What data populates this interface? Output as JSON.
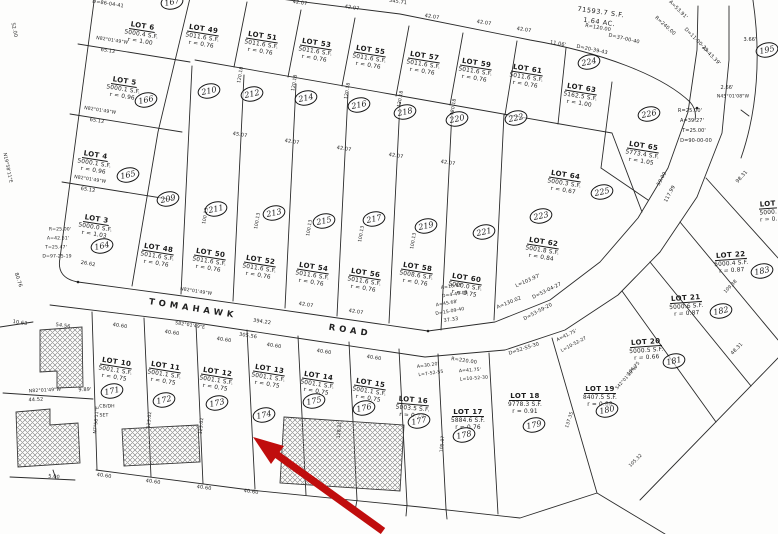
{
  "road": {
    "word1": "TOMAHAWK",
    "word2": "ROAD"
  },
  "open_parcel": {
    "area": "71593.7 S.F.",
    "acres": "1.64 AC."
  },
  "arrow": {
    "color": "#c00d0d"
  },
  "lots": [
    {
      "name": "LOT 6",
      "area": "5000.4 S.F.",
      "ratio": "r = 1.00",
      "x": 142,
      "y": 14,
      "rot": 9
    },
    {
      "name": "LOT 5",
      "area": "5000.1 S.F.",
      "ratio": "r = 0.96",
      "x": 124,
      "y": 69,
      "rot": 9
    },
    {
      "name": "LOT 4",
      "area": "5000.1 S.F.",
      "ratio": "r = 0.96",
      "x": 95,
      "y": 143,
      "rot": 9
    },
    {
      "name": "LOT 3",
      "area": "5000.0 S.F.",
      "ratio": "r = 1.03",
      "x": 96,
      "y": 207,
      "rot": 9
    },
    {
      "name": "LOT 49",
      "area": "5011.6 S.F.",
      "ratio": "r = 0.76",
      "x": 203,
      "y": 17,
      "rot": 9
    },
    {
      "name": "LOT 51",
      "area": "5011.6 S.F.",
      "ratio": "r = 0.76",
      "x": 262,
      "y": 24,
      "rot": 9
    },
    {
      "name": "LOT 53",
      "area": "5011.6 S.F.",
      "ratio": "r = 0.76",
      "x": 316,
      "y": 31,
      "rot": 9
    },
    {
      "name": "LOT 55",
      "area": "5011.6 S.F.",
      "ratio": "r = 0.76",
      "x": 370,
      "y": 38,
      "rot": 9
    },
    {
      "name": "LOT 57",
      "area": "5011.6 S.F.",
      "ratio": "r = 0.76",
      "x": 424,
      "y": 44,
      "rot": 9
    },
    {
      "name": "LOT 59",
      "area": "5011.6 S.F.",
      "ratio": "r = 0.76",
      "x": 476,
      "y": 51,
      "rot": 9
    },
    {
      "name": "LOT 61",
      "area": "5011.6 S.F.",
      "ratio": "r = 0.76",
      "x": 527,
      "y": 57,
      "rot": 9
    },
    {
      "name": "LOT 63",
      "area": "5162.5 S.F.",
      "ratio": "r = 1.00",
      "x": 581,
      "y": 76,
      "rot": 9
    },
    {
      "name": "LOT 65",
      "area": "5773.4 S.F.",
      "ratio": "r = 1.05",
      "x": 643,
      "y": 134,
      "rot": 9
    },
    {
      "name": "LOT 64",
      "area": "5000.3 S.F.",
      "ratio": "r = 0.67",
      "x": 565,
      "y": 163,
      "rot": 9
    },
    {
      "name": "LOT 48",
      "area": "5011.6 S.F.",
      "ratio": "r = 0.76",
      "x": 158,
      "y": 236,
      "rot": 9
    },
    {
      "name": "LOT 50",
      "area": "5011.6 S.F.",
      "ratio": "r = 0.76",
      "x": 210,
      "y": 241,
      "rot": 9
    },
    {
      "name": "LOT 52",
      "area": "5011.6 S.F.",
      "ratio": "r = 0.76",
      "x": 260,
      "y": 248,
      "rot": 9
    },
    {
      "name": "LOT 54",
      "area": "5011.6 S.F.",
      "ratio": "r = 0.76",
      "x": 313,
      "y": 255,
      "rot": 9
    },
    {
      "name": "LOT 56",
      "area": "5011.6 S.F.",
      "ratio": "r = 0.76",
      "x": 365,
      "y": 261,
      "rot": 9
    },
    {
      "name": "LOT 58",
      "area": "5008.6 S.F.",
      "ratio": "r = 0.76",
      "x": 417,
      "y": 255,
      "rot": 9
    },
    {
      "name": "LOT 60",
      "area": "5000.0 S.F.",
      "ratio": "r = 0.75",
      "x": 466,
      "y": 266,
      "rot": 9
    },
    {
      "name": "LOT 62",
      "area": "5001.8 S.F.",
      "ratio": "r = 0.84",
      "x": 543,
      "y": 230,
      "rot": 9
    },
    {
      "name": "LOT 10",
      "area": "5001.1 S.F.",
      "ratio": "r = 0.75",
      "x": 116,
      "y": 350,
      "rot": 9
    },
    {
      "name": "LOT 11",
      "area": "5001.1 S.F.",
      "ratio": "r = 0.75",
      "x": 165,
      "y": 354,
      "rot": 9
    },
    {
      "name": "LOT 12",
      "area": "5001.1 S.F.",
      "ratio": "r = 0.75",
      "x": 217,
      "y": 360,
      "rot": 9
    },
    {
      "name": "LOT 13",
      "area": "5001.1 S.F.",
      "ratio": "r = 0.75",
      "x": 269,
      "y": 357,
      "rot": 9
    },
    {
      "name": "LOT 14",
      "area": "5001.1 S.F.",
      "ratio": "r = 0.75",
      "x": 318,
      "y": 364,
      "rot": 9
    },
    {
      "name": "LOT 15",
      "area": "5001.1 S.F.",
      "ratio": "r = 0.75",
      "x": 370,
      "y": 371,
      "rot": 9
    },
    {
      "name": "LOT 16",
      "area": "5003.5 S.F.",
      "ratio": "r = 0.74",
      "x": 413,
      "y": 388,
      "rot": 5
    },
    {
      "name": "LOT 17",
      "area": "5884.6 S.F.",
      "ratio": "r = 0.76",
      "x": 468,
      "y": 400,
      "rot": 0
    },
    {
      "name": "LOT 18",
      "area": "9778.3 S.F.",
      "ratio": "r = 0.91",
      "x": 525,
      "y": 384,
      "rot": 0
    },
    {
      "name": "LOT 19",
      "area": "8407.5 S.F.",
      "ratio": "r = 0.88",
      "x": 600,
      "y": 377,
      "rot": 0
    },
    {
      "name": "LOT 20",
      "area": "5000.5 S.F.",
      "ratio": "r = 0.66",
      "x": 646,
      "y": 330,
      "rot": -4
    },
    {
      "name": "LOT 21",
      "area": "5000.6 S.F.",
      "ratio": "r = 0.87",
      "x": 686,
      "y": 286,
      "rot": -4
    },
    {
      "name": "LOT 22",
      "area": "5000.4 S.F.",
      "ratio": "r = 0.87",
      "x": 731,
      "y": 243,
      "rot": -4
    },
    {
      "name": "LOT",
      "area": "5000.",
      "ratio": "r = 0.",
      "x": 768,
      "y": 192,
      "rot": -4
    }
  ],
  "badges": [
    {
      "num": "167",
      "x": 172,
      "y": 2
    },
    {
      "num": "166",
      "x": 146,
      "y": 100
    },
    {
      "num": "165",
      "x": 128,
      "y": 175
    },
    {
      "num": "164",
      "x": 102,
      "y": 246
    },
    {
      "num": "210",
      "x": 209,
      "y": 91
    },
    {
      "num": "212",
      "x": 252,
      "y": 94
    },
    {
      "num": "214",
      "x": 306,
      "y": 98
    },
    {
      "num": "216",
      "x": 359,
      "y": 105
    },
    {
      "num": "218",
      "x": 405,
      "y": 112
    },
    {
      "num": "220",
      "x": 457,
      "y": 119
    },
    {
      "num": "222",
      "x": 516,
      "y": 118
    },
    {
      "num": "224",
      "x": 589,
      "y": 62
    },
    {
      "num": "226",
      "x": 649,
      "y": 114
    },
    {
      "num": "209",
      "x": 168,
      "y": 199
    },
    {
      "num": "211",
      "x": 216,
      "y": 209
    },
    {
      "num": "213",
      "x": 274,
      "y": 213
    },
    {
      "num": "215",
      "x": 324,
      "y": 221
    },
    {
      "num": "217",
      "x": 374,
      "y": 219
    },
    {
      "num": "219",
      "x": 426,
      "y": 226
    },
    {
      "num": "221",
      "x": 484,
      "y": 232
    },
    {
      "num": "223",
      "x": 541,
      "y": 216
    },
    {
      "num": "225",
      "x": 602,
      "y": 192
    },
    {
      "num": "171",
      "x": 112,
      "y": 391
    },
    {
      "num": "172",
      "x": 164,
      "y": 400
    },
    {
      "num": "173",
      "x": 217,
      "y": 403
    },
    {
      "num": "174",
      "x": 264,
      "y": 415
    },
    {
      "num": "175",
      "x": 314,
      "y": 401
    },
    {
      "num": "176",
      "x": 364,
      "y": 408
    },
    {
      "num": "177",
      "x": 419,
      "y": 421
    },
    {
      "num": "178",
      "x": 464,
      "y": 435
    },
    {
      "num": "179",
      "x": 534,
      "y": 425
    },
    {
      "num": "180",
      "x": 607,
      "y": 410
    },
    {
      "num": "181",
      "x": 674,
      "y": 361
    },
    {
      "num": "182",
      "x": 721,
      "y": 311
    },
    {
      "num": "183",
      "x": 762,
      "y": 271
    },
    {
      "num": "195",
      "x": 767,
      "y": 50
    }
  ],
  "annotations": [
    {
      "text": "D=86-04-41",
      "x": 108,
      "y": 4,
      "rot": 9
    },
    {
      "text": "42.07",
      "x": 300,
      "y": 3,
      "rot": 9
    },
    {
      "text": "42.07",
      "x": 352,
      "y": 8,
      "rot": 9
    },
    {
      "text": "345.71",
      "x": 398,
      "y": 2,
      "rot": 9
    },
    {
      "text": "42.07",
      "x": 432,
      "y": 17,
      "rot": 9
    },
    {
      "text": "42.07",
      "x": 484,
      "y": 23,
      "rot": 9
    },
    {
      "text": "42.07",
      "x": 524,
      "y": 30,
      "rot": 9
    },
    {
      "text": "N82°01'49\"W",
      "x": 112,
      "y": 41,
      "rot": 9,
      "size": 4.6
    },
    {
      "text": "65.12",
      "x": 108,
      "y": 51,
      "rot": 9
    },
    {
      "text": "N82°01'49\"W",
      "x": 100,
      "y": 111,
      "rot": 9,
      "size": 4.6
    },
    {
      "text": "65.12",
      "x": 97,
      "y": 121,
      "rot": 9
    },
    {
      "text": "N82°01'49\"W",
      "x": 90,
      "y": 180,
      "rot": 9,
      "size": 4.6
    },
    {
      "text": "65.12",
      "x": 88,
      "y": 190,
      "rot": 9
    },
    {
      "text": "52.00",
      "x": 14,
      "y": 30,
      "rot": 78
    },
    {
      "text": "N19°58'11\"E",
      "x": 7,
      "y": 168,
      "rot": 78,
      "size": 4.6
    },
    {
      "text": "80.76",
      "x": 18,
      "y": 280,
      "rot": 72
    },
    {
      "text": "26.62",
      "x": 88,
      "y": 264,
      "rot": 10
    },
    {
      "text": "120.18",
      "x": 241,
      "y": 75,
      "rot": -80,
      "size": 4.6
    },
    {
      "text": "120.18",
      "x": 295,
      "y": 83,
      "rot": -80,
      "size": 4.6
    },
    {
      "text": "120.18",
      "x": 348,
      "y": 91,
      "rot": -80,
      "size": 4.6
    },
    {
      "text": "120.18",
      "x": 401,
      "y": 99,
      "rot": -80,
      "size": 4.6
    },
    {
      "text": "120.18",
      "x": 454,
      "y": 107,
      "rot": -80,
      "size": 4.6
    },
    {
      "text": "45.07",
      "x": 240,
      "y": 135,
      "rot": 9
    },
    {
      "text": "42.07",
      "x": 292,
      "y": 142,
      "rot": 9
    },
    {
      "text": "42.07",
      "x": 344,
      "y": 149,
      "rot": 9
    },
    {
      "text": "42.07",
      "x": 396,
      "y": 156,
      "rot": 9
    },
    {
      "text": "42.07",
      "x": 448,
      "y": 163,
      "rot": 9
    },
    {
      "text": "100.13",
      "x": 206,
      "y": 216,
      "rot": -80,
      "size": 4.6
    },
    {
      "text": "100.13",
      "x": 258,
      "y": 221,
      "rot": -80,
      "size": 4.6
    },
    {
      "text": "100.13",
      "x": 310,
      "y": 228,
      "rot": -80,
      "size": 4.6
    },
    {
      "text": "100.13",
      "x": 362,
      "y": 234,
      "rot": -80,
      "size": 4.6
    },
    {
      "text": "100.13",
      "x": 414,
      "y": 241,
      "rot": -80,
      "size": 4.6
    },
    {
      "text": "R=120.00",
      "x": 598,
      "y": 28,
      "rot": 10
    },
    {
      "text": "D=37-00-40",
      "x": 624,
      "y": 39,
      "rot": 13
    },
    {
      "text": "11.06'",
      "x": 558,
      "y": 44,
      "rot": 10
    },
    {
      "text": "D=20-39-43",
      "x": 592,
      "y": 50,
      "rot": 12
    },
    {
      "text": "A=53.91'",
      "x": 678,
      "y": 10,
      "rot": 45
    },
    {
      "text": "R=240.00",
      "x": 665,
      "y": 26,
      "rot": 42
    },
    {
      "text": "D=11-00-29",
      "x": 696,
      "y": 40,
      "rot": 45
    },
    {
      "text": "A=43.39'",
      "x": 711,
      "y": 56,
      "rot": 45
    },
    {
      "text": "3.66'",
      "x": 750,
      "y": 40,
      "rot": 0
    },
    {
      "text": "2.66'",
      "x": 727,
      "y": 88,
      "rot": 0
    },
    {
      "text": "N45°01'08\"W",
      "x": 733,
      "y": 97,
      "rot": 0,
      "size": 4.6
    },
    {
      "text": "R=25.00'",
      "x": 690,
      "y": 111,
      "rot": 0
    },
    {
      "text": "A=39.27'",
      "x": 692,
      "y": 121,
      "rot": 0
    },
    {
      "text": "T=25.00'",
      "x": 694,
      "y": 131,
      "rot": 0
    },
    {
      "text": "D=90-00-00",
      "x": 696,
      "y": 141,
      "rot": 0
    },
    {
      "text": "59.09",
      "x": 662,
      "y": 179,
      "rot": -62
    },
    {
      "text": "117.99",
      "x": 670,
      "y": 194,
      "rot": -62
    },
    {
      "text": "98.31",
      "x": 742,
      "y": 177,
      "rot": -48
    },
    {
      "text": "N82°01'49\"W",
      "x": 196,
      "y": 292,
      "rot": 9,
      "size": 4.6
    },
    {
      "text": "394.22",
      "x": 262,
      "y": 322,
      "rot": 9
    },
    {
      "text": "42.07",
      "x": 306,
      "y": 305,
      "rot": 9
    },
    {
      "text": "42.07",
      "x": 356,
      "y": 312,
      "rot": 9
    },
    {
      "text": "A=16.93'",
      "x": 452,
      "y": 287,
      "rot": -8,
      "size": 4.6
    },
    {
      "text": "D=4-49-08",
      "x": 455,
      "y": 295,
      "rot": -8,
      "size": 4.6
    },
    {
      "text": "A=45.68'",
      "x": 447,
      "y": 304,
      "rot": -10,
      "size": 4.6
    },
    {
      "text": "D=15-09-40",
      "x": 450,
      "y": 312,
      "rot": -10,
      "size": 4.6
    },
    {
      "text": "37.33",
      "x": 451,
      "y": 320,
      "rot": -8
    },
    {
      "text": "L=103.97'",
      "x": 528,
      "y": 281,
      "rot": -24
    },
    {
      "text": "D=53-04-27",
      "x": 547,
      "y": 291,
      "rot": -26
    },
    {
      "text": "A=130.02",
      "x": 509,
      "y": 303,
      "rot": -22
    },
    {
      "text": "D=53-59-20",
      "x": 538,
      "y": 312,
      "rot": -28
    },
    {
      "text": "S82°01'49\"E",
      "x": 190,
      "y": 326,
      "rot": 9,
      "size": 4.6
    },
    {
      "text": "305.56",
      "x": 248,
      "y": 336,
      "rot": 9
    },
    {
      "text": "40.60",
      "x": 120,
      "y": 326,
      "rot": 9
    },
    {
      "text": "40.60",
      "x": 172,
      "y": 333,
      "rot": 9
    },
    {
      "text": "40.60",
      "x": 224,
      "y": 340,
      "rot": 9
    },
    {
      "text": "40.60",
      "x": 274,
      "y": 346,
      "rot": 9
    },
    {
      "text": "40.60",
      "x": 324,
      "y": 352,
      "rot": 9
    },
    {
      "text": "40.60",
      "x": 374,
      "y": 358,
      "rot": 9
    },
    {
      "text": "R=220.00",
      "x": 464,
      "y": 361,
      "rot": 8
    },
    {
      "text": "A=41.75'",
      "x": 470,
      "y": 371,
      "rot": -4,
      "size": 4.6
    },
    {
      "text": "L=10-52-30",
      "x": 474,
      "y": 379,
      "rot": -4,
      "size": 4.6
    },
    {
      "text": "D=52-55-30",
      "x": 524,
      "y": 349,
      "rot": -18
    },
    {
      "text": "A=41.75'",
      "x": 567,
      "y": 336,
      "rot": -26,
      "size": 4.6
    },
    {
      "text": "L=10-52-27",
      "x": 574,
      "y": 345,
      "rot": -28,
      "size": 4.6
    },
    {
      "text": "A=30.20'",
      "x": 428,
      "y": 366,
      "rot": -8,
      "size": 4.6
    },
    {
      "text": "L=7-52-55",
      "x": 431,
      "y": 374,
      "rot": -8,
      "size": 4.6
    },
    {
      "text": "CB/DH",
      "x": 107,
      "y": 407,
      "rot": 0,
      "size": 4.6
    },
    {
      "text": "SET",
      "x": 104,
      "y": 416,
      "rot": 0,
      "size": 4.6
    },
    {
      "text": "10.63",
      "x": 20,
      "y": 323,
      "rot": 9
    },
    {
      "text": "54.56",
      "x": 63,
      "y": 326,
      "rot": 8
    },
    {
      "text": "N82°01'49\"W",
      "x": 45,
      "y": 391,
      "rot": -3,
      "size": 4.6
    },
    {
      "text": "9.89'",
      "x": 85,
      "y": 390,
      "rot": -3
    },
    {
      "text": "44.52",
      "x": 36,
      "y": 400,
      "rot": -3
    },
    {
      "text": "5.00",
      "x": 54,
      "y": 477,
      "rot": 5
    },
    {
      "text": "40.60",
      "x": 104,
      "y": 476,
      "rot": 8
    },
    {
      "text": "40.60",
      "x": 153,
      "y": 482,
      "rot": 8
    },
    {
      "text": "40.60",
      "x": 204,
      "y": 488,
      "rot": 8
    },
    {
      "text": "40.60",
      "x": 251,
      "y": 492,
      "rot": 8
    },
    {
      "text": "N7°58'11\"E",
      "x": 97,
      "y": 420,
      "rot": -85,
      "size": 4.6
    },
    {
      "text": "123.02",
      "x": 150,
      "y": 420,
      "rot": -85,
      "size": 4.6
    },
    {
      "text": "123.02",
      "x": 202,
      "y": 426,
      "rot": -85,
      "size": 4.6
    },
    {
      "text": "128.21",
      "x": 340,
      "y": 430,
      "rot": -85,
      "size": 4.6
    },
    {
      "text": "105.07",
      "x": 443,
      "y": 444,
      "rot": -85,
      "size": 4.6
    },
    {
      "text": "137.35",
      "x": 570,
      "y": 420,
      "rot": -72,
      "size": 4.6
    },
    {
      "text": "106.75",
      "x": 634,
      "y": 369,
      "rot": -48,
      "size": 4.6
    },
    {
      "text": "S42°01'09\"W",
      "x": 627,
      "y": 378,
      "rot": -48,
      "size": 4.4
    },
    {
      "text": "109.38",
      "x": 731,
      "y": 287,
      "rot": -46,
      "size": 4.6
    },
    {
      "text": "48.31",
      "x": 737,
      "y": 349,
      "rot": -46
    },
    {
      "text": "105.32",
      "x": 636,
      "y": 461,
      "rot": -45,
      "size": 4.6
    },
    {
      "text": "R=25.00'",
      "x": 60,
      "y": 230,
      "rot": 0,
      "size": 4.6
    },
    {
      "text": "A=42.51'",
      "x": 58,
      "y": 239,
      "rot": 0,
      "size": 4.6
    },
    {
      "text": "T=25.47'",
      "x": 56,
      "y": 248,
      "rot": 0,
      "size": 4.6
    },
    {
      "text": "D=97-25-19",
      "x": 57,
      "y": 257,
      "rot": 0,
      "size": 4.6
    }
  ]
}
